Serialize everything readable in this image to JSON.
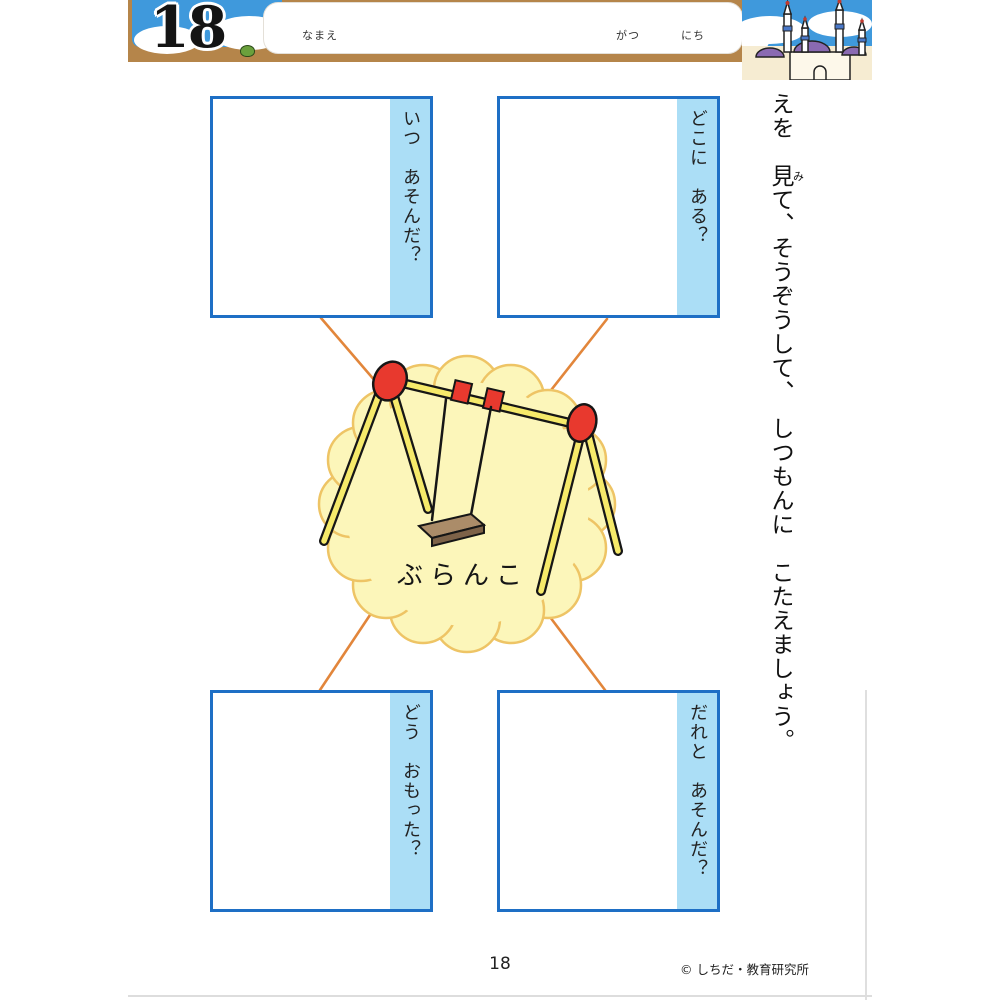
{
  "lesson": {
    "number": "18"
  },
  "header": {
    "name_label": "なまえ",
    "month_label": "がつ",
    "day_label": "にち"
  },
  "instruction": {
    "before": "えを　",
    "kanji": "見",
    "furigana": "み",
    "after": "て、そうぞうして、　しつもんに　こたえましょう。"
  },
  "topic": {
    "label": "ぶらんこ"
  },
  "questions": [
    {
      "id": "when",
      "label": "いつ　あそんだ？"
    },
    {
      "id": "where",
      "label": "どこに　ある？"
    },
    {
      "id": "how",
      "label": "どう　おもった？"
    },
    {
      "id": "who",
      "label": "だれと　あそんだ？"
    }
  ],
  "footer": {
    "page_number": "18",
    "copyright": "© しちだ・教育研究所"
  },
  "colors": {
    "box_border": "#1e6fc5",
    "label_strip": "#abdef6",
    "cloud_fill": "#fcf6ba",
    "cloud_border": "#eec465",
    "connector_line": "#e2863b",
    "header_ground": "#b5854a",
    "sky": "#3f99dc",
    "swing_pole": "#f6ea6a",
    "swing_red": "#e8392e",
    "seat_brown": "#a08263",
    "dome_purple": "#8a6ab2"
  }
}
